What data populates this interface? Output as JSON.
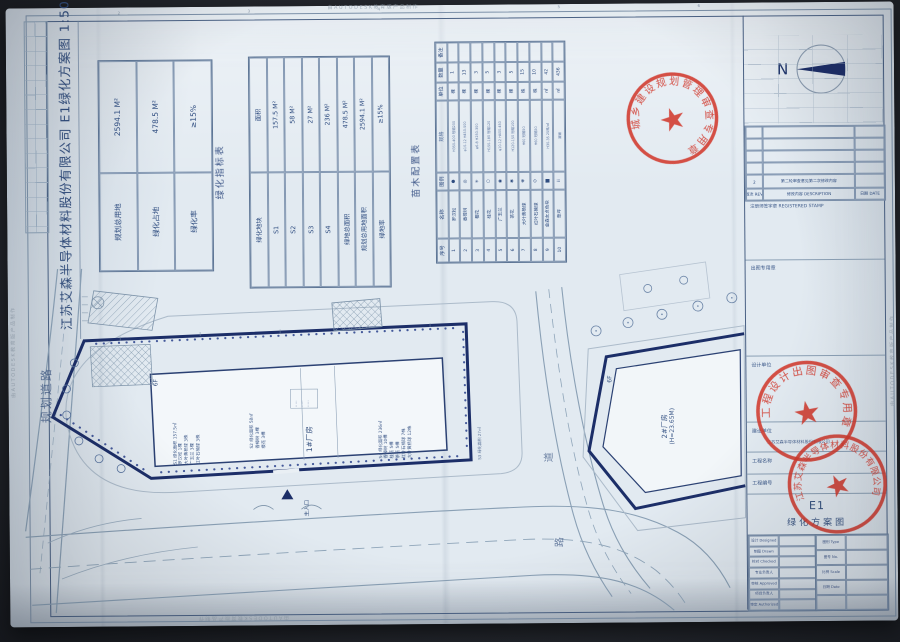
{
  "watermark": {
    "text": "由AUTODESK教育版产品制作"
  },
  "title_strip": {
    "company_title": "江苏艾森半导体材料股份有限公司  E1绿化方案图  1:500"
  },
  "compass": {
    "label": "N"
  },
  "indicator_table": {
    "caption": "绿化指标表",
    "rows": [
      [
        "规划总用地",
        "2594.1 M²"
      ],
      [
        "绿化占地",
        "478.5 M²"
      ],
      [
        "绿化率",
        "≥15%"
      ]
    ]
  },
  "plots_table": {
    "rows": [
      [
        "绿化地块",
        "面积"
      ],
      [
        "S1",
        "157.5 M²"
      ],
      [
        "S2",
        "58 M²"
      ],
      [
        "S3",
        "27 M²"
      ],
      [
        "S4",
        "236 M²"
      ],
      [
        "绿地总面积",
        "478.5 M²"
      ],
      [
        "规划总用地面积",
        "2594.1 M²"
      ],
      [
        "绿地率",
        "≥15%"
      ]
    ]
  },
  "plants_table": {
    "caption": "苗木配置表",
    "rows": [
      [
        "序号",
        "名称",
        "图例",
        "规格",
        "单位",
        "数量",
        "备注"
      ],
      [
        "1",
        "罗汉松",
        "●",
        "H350-400 冠幅200",
        "棵",
        "1",
        ""
      ],
      [
        "2",
        "香樟树",
        "◎",
        "φ10-12 H450-500",
        "棵",
        "13",
        ""
      ],
      [
        "3",
        "樱花",
        "✳",
        "φ6-8 H250-300",
        "棵",
        "3",
        ""
      ],
      [
        "4",
        "桂花",
        "○",
        "H150-180 冠幅120",
        "棵",
        "5",
        ""
      ],
      [
        "5",
        "广玉兰",
        "◉",
        "φ10-12 H400-450",
        "棵",
        "3",
        ""
      ],
      [
        "6",
        "茶花",
        "✱",
        "H120-150 冠幅100",
        "棵",
        "5",
        ""
      ],
      [
        "7",
        "大叶黄杨球",
        "❋",
        "H60 冠幅50",
        "株",
        "15",
        ""
      ],
      [
        "8",
        "红叶石楠球",
        "⊙",
        "H60 冠幅50",
        "株",
        "10",
        ""
      ],
      [
        "9",
        "金森女贞色块",
        "▆",
        "H30-35 25株/㎡",
        "㎡",
        "42",
        ""
      ],
      [
        "10",
        "草坪",
        "⠿",
        "满铺",
        "㎡",
        "436",
        ""
      ]
    ]
  },
  "plan": {
    "road_left": "规划道路",
    "road_char_1": "道",
    "road_char_2": "路",
    "entrance": "主入口",
    "building1": "1#厂房",
    "building1_floors": "6F",
    "building2_line1": "2#厂房",
    "building2_line2": "(H=23.65M)",
    "building2_floors": "6F",
    "s1_notes": [
      "S1 绿化面积 157.5㎡",
      "罗汉松 1棵",
      "大叶黄杨球 3株",
      "广玉兰 3棵",
      "红叶石楠球 3株"
    ],
    "s2_notes": [
      "S2 绿化面积 58㎡",
      "香樟树 3棵",
      "樱花 3棵"
    ],
    "s4_notes": [
      "S4 绿化面积 236㎡",
      "香樟树 10棵",
      "桂花 5棵",
      "茶花 5棵",
      "红叶石楠球 7株",
      "大叶黄杨球 12株"
    ],
    "s3_note": "S3 绿化面积 27㎡",
    "room_notes": [
      "·····",
      "·····",
      "·····"
    ]
  },
  "titleblock": {
    "rev_table_rows": [
      [
        "",
        "",
        ""
      ],
      [
        "",
        "",
        ""
      ],
      [
        "",
        "",
        ""
      ],
      [
        "",
        "",
        ""
      ],
      [
        "2",
        "第二轮审查意见第二次修改内容",
        ""
      ],
      [
        "版次 REV.",
        "修改内容 DESCRIPTION",
        "日期 DATE"
      ]
    ],
    "registered_label": "注册师签字章  REGISTERED STAMP",
    "seal_label": "出图专用章",
    "design_unit_label": "设计单位",
    "client_label": "建设单位",
    "client_value": "江苏艾森半导体材料股份有限公司",
    "project_label": "工程名称",
    "project_no_label": "工程编号",
    "drawing_no": "E1",
    "drawing_name": "绿化方案图",
    "sig_left_rows": [
      [
        "设计 Designed",
        ""
      ],
      [
        "制图 Drawn",
        ""
      ],
      [
        "校对 Checked",
        ""
      ],
      [
        "专业负责人",
        ""
      ],
      [
        "审核 Approved",
        ""
      ],
      [
        "项目负责人",
        ""
      ],
      [
        "审定 Authorized",
        ""
      ]
    ],
    "sig_right_rows": [
      [
        "图别 Type",
        ""
      ],
      [
        "图号 No.",
        ""
      ],
      [
        "比例 Scale",
        ""
      ],
      [
        "日期 Date",
        ""
      ],
      [
        "",
        ""
      ]
    ]
  },
  "stamps": {
    "planning_seal": "城乡建设规划管理审查专用章",
    "design_seal": "工程设计出图审查专用章",
    "company_seal": "江苏艾森半导体材料股份有限公司"
  },
  "colors": {
    "boundary_navy": "#1c2e68",
    "stamp_red": "#d23a2e",
    "line_blue": "#5d7697",
    "paper": "#e2eaf1"
  }
}
